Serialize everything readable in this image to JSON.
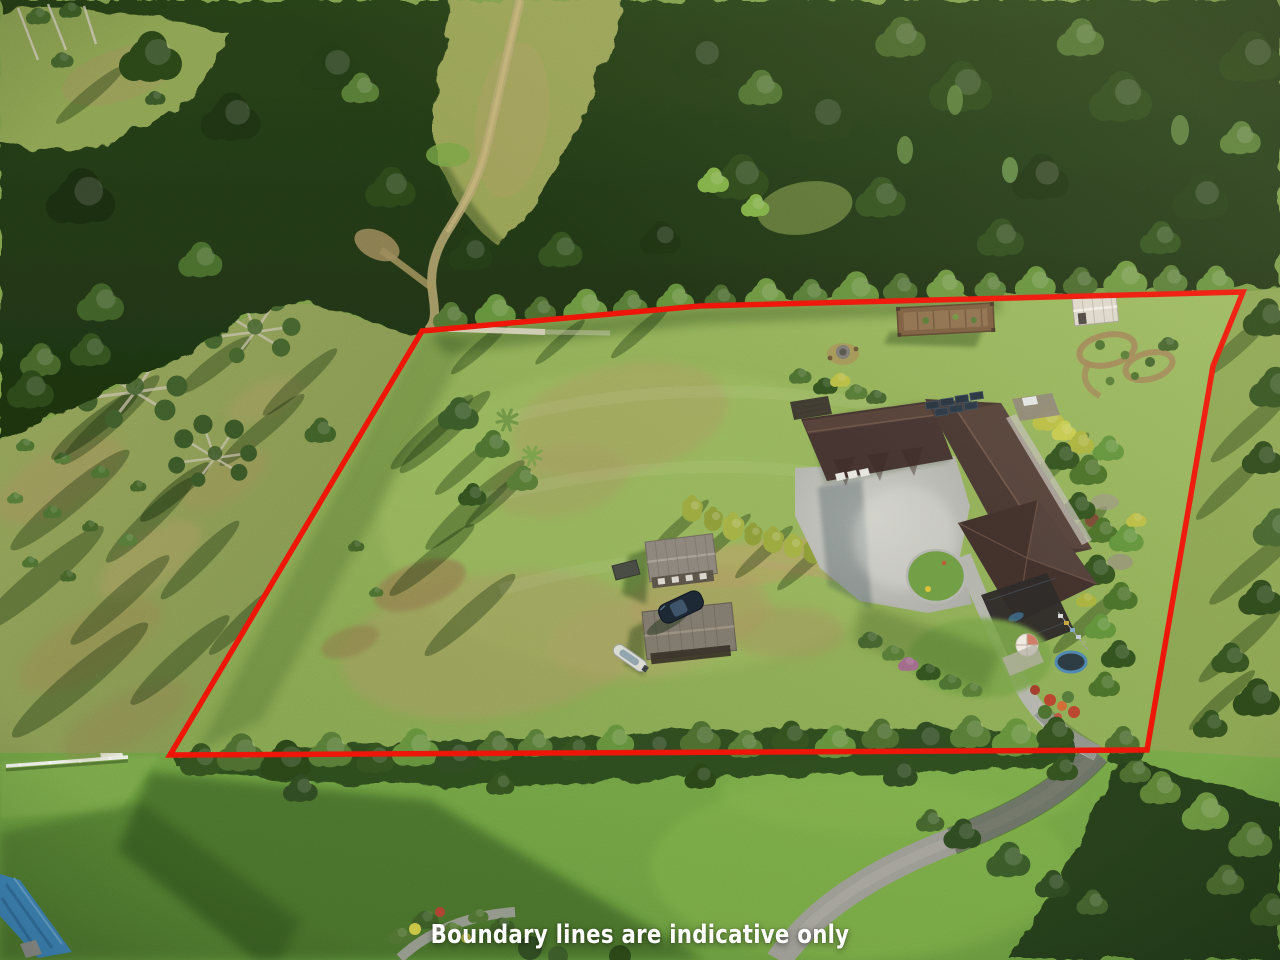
{
  "caption": {
    "text": "Boundary lines are indicative only",
    "color": "#ffffff"
  },
  "boundary": {
    "color": "#ee1408",
    "stroke_width": 5.5,
    "closed": true,
    "points": [
      [
        422,
        331
      ],
      [
        700,
        306
      ],
      [
        1243,
        292
      ],
      [
        1213,
        366
      ],
      [
        1147,
        750
      ],
      [
        170,
        755
      ]
    ]
  },
  "scene": {
    "type": "aerial-photograph",
    "description": "Drone aerial photo of a rural lifestyle property: large brown-roofed house with concrete courtyard, two sheds, car and boat, paddocks, gardens, surrounding native bush, with red property boundary overlay",
    "palette": {
      "forest": "#243c16",
      "pasture": "#8d9b55",
      "paddock": "#8fae55",
      "lawn": "#6f9f42",
      "dry_grass": "#a89e60",
      "roof": "#46342d",
      "concrete": "#bcbdb6",
      "road": "#9a9a92",
      "boundary_red": "#ee1408"
    }
  }
}
